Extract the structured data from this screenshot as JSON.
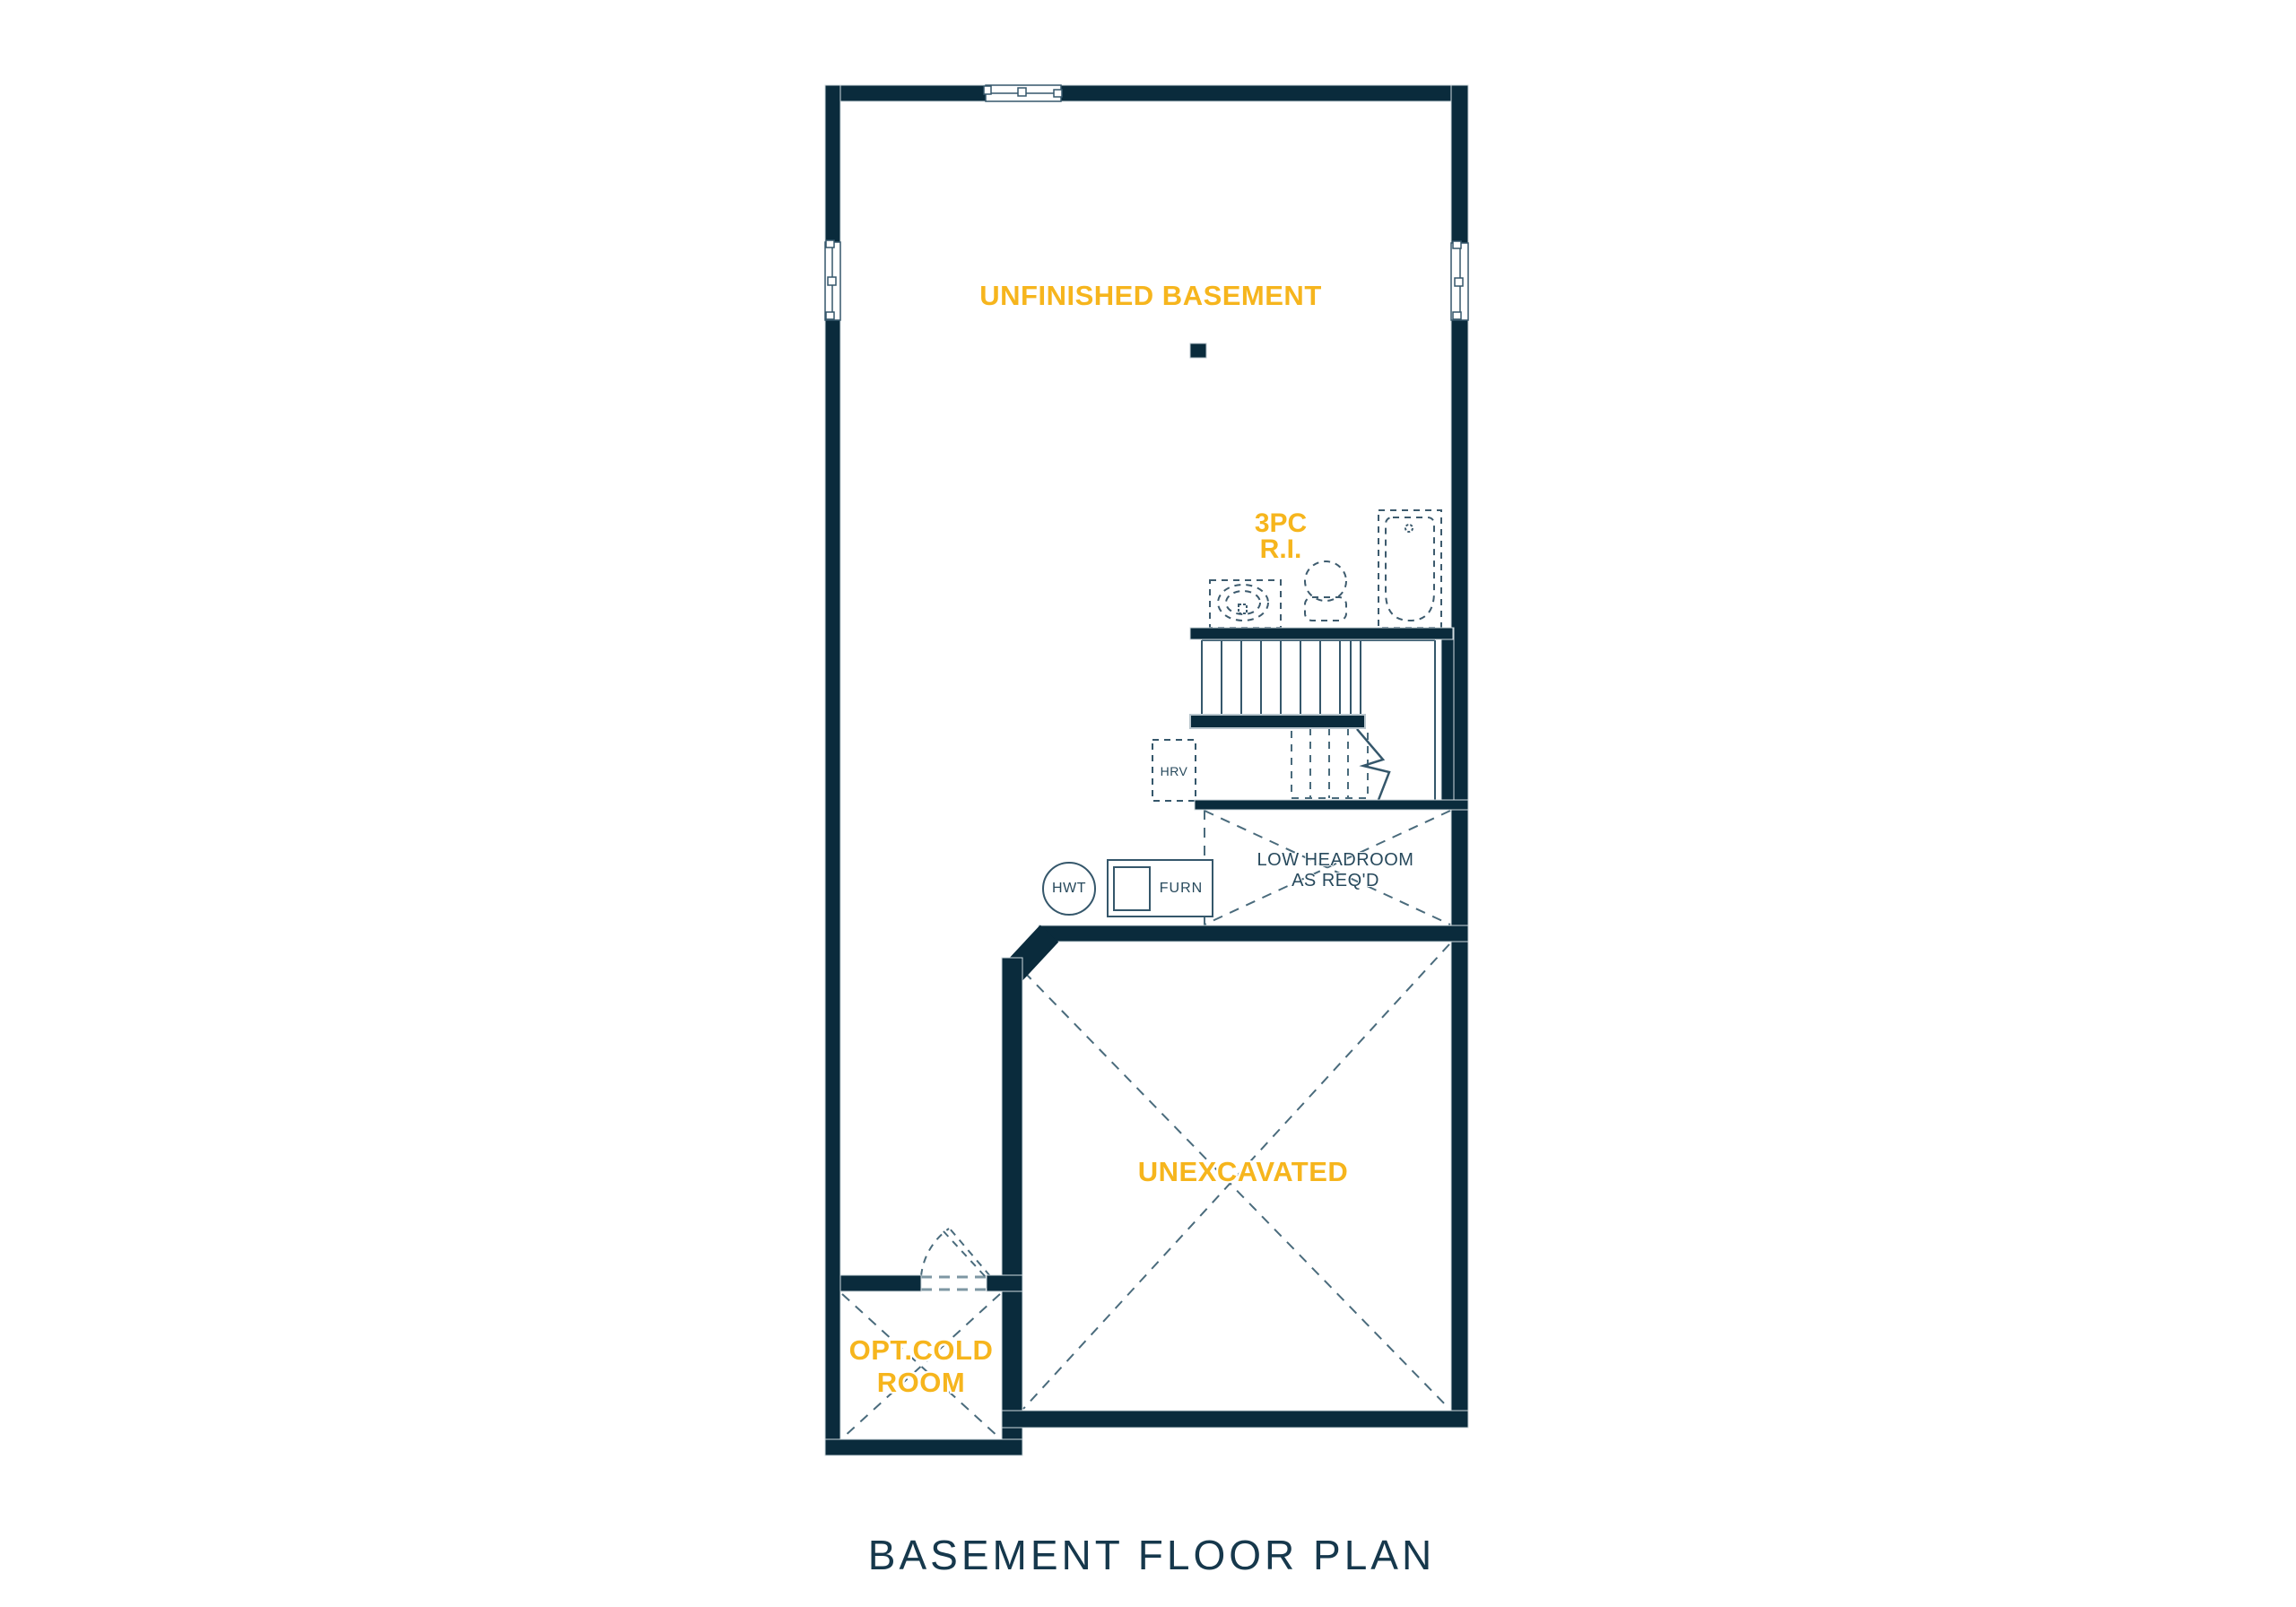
{
  "plan": {
    "title": "BASEMENT FLOOR PLAN",
    "labels": {
      "unfinished_basement": "UNFINISHED BASEMENT",
      "bath_ri_line1": "3PC",
      "bath_ri_line2": "R.I.",
      "hrv": "HRV",
      "hwt": "HWT",
      "furnace": "FURN",
      "low_headroom_line1": "LOW HEADROOM",
      "low_headroom_line2": "AS REQ'D",
      "unexcavated": "UNEXCAVATED",
      "cold_room_line1": "OPT.COLD",
      "cold_room_line2": "ROOM"
    },
    "colors": {
      "background": "#FFFFFF",
      "wall": "#0A2B3C",
      "accent_yellow": "#F6B51D",
      "thin_line": "#35576B",
      "dashed_line": "#4A6B7C",
      "light_dash": "#7E97A3",
      "title_text": "#16384C"
    }
  }
}
